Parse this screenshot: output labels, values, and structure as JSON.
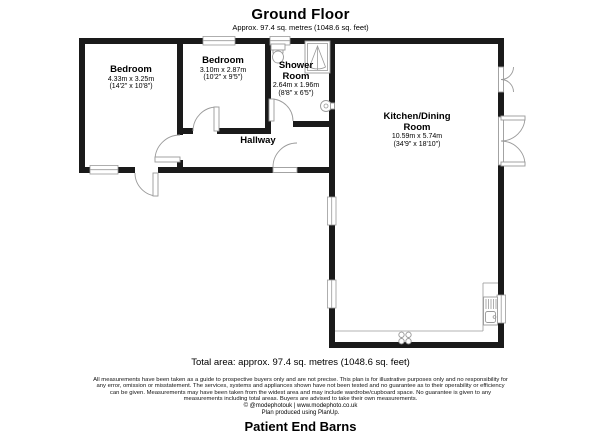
{
  "header": {
    "title": "Ground Floor",
    "subtitle": "Approx. 97.4 sq. metres (1048.6 sq. feet)"
  },
  "rooms": [
    {
      "name": "Bedroom",
      "dims_m": "4.33m x 3.25m",
      "dims_ft": "(14'2\" x 10'8\")"
    },
    {
      "name": "Bedroom",
      "dims_m": "3.10m x 2.87m",
      "dims_ft": "(10'2\" x 9'5\")"
    },
    {
      "name": "Shower Room",
      "dims_m": "2.64m x 1.96m",
      "dims_ft": "(8'8\" x 6'5\")"
    },
    {
      "name": "Hallway"
    },
    {
      "name": "Kitchen/Dining Room",
      "dims_m": "10.59m x 5.74m",
      "dims_ft": "(34'9\" x 18'10\")"
    }
  ],
  "footer": {
    "total_area": "Total area: approx. 97.4 sq. metres (1048.6 sq. feet)",
    "disclaimer_lines": [
      "All measurements have been taken as a guide to prospective buyers only and are not precise. This plan is for illustrative purposes only and no responsibility for",
      "any error, omission or misstatement. The services, systems and appliances shown have not been tested and no guarantee as to their operability or efficiency",
      "can be given. Measurements may have been taken from the widest area and may include wardrobe/cupboard space. No guarantee is given to any",
      "measurements including total areas. Buyers are advised to take their own measurements."
    ],
    "credit": "© @modephotouk | www.modephoto.co.uk",
    "produced": "Plan produced using PlanUp.",
    "property_name": "Patient End Barns"
  },
  "colors": {
    "wall": "#1a1a1a",
    "fixture_line": "#9a9a9a",
    "text": "#000000"
  }
}
